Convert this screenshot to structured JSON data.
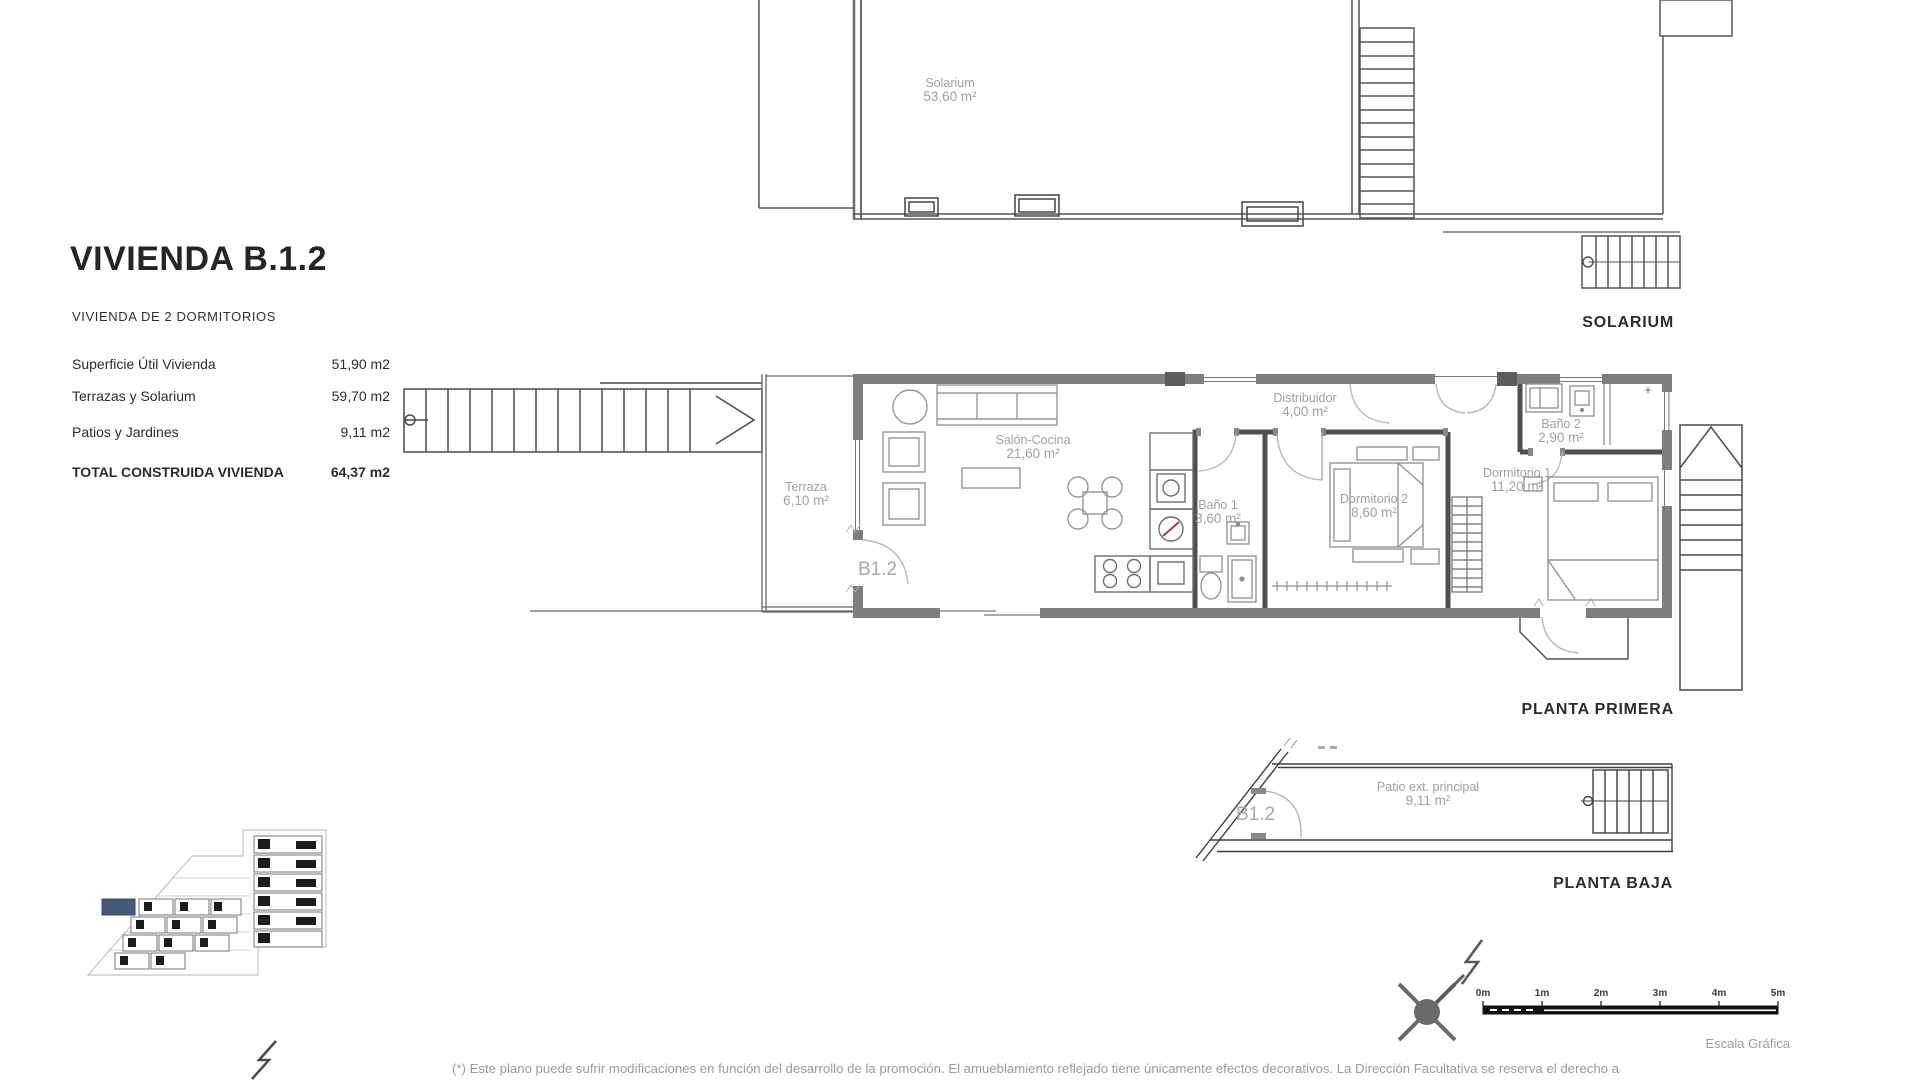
{
  "header": {
    "title": "VIVIENDA B.1.2",
    "subtitle": "VIVIENDA DE 2 DORMITORIOS"
  },
  "areas_table": {
    "rows": [
      {
        "label": "Superficie Útil Vivienda",
        "value": "51,90 m2"
      },
      {
        "label": "Terrazas y Solarium",
        "value": "59,70 m2"
      },
      {
        "label": "Patios y Jardines",
        "value": "9,11 m2"
      }
    ],
    "total_row": {
      "label": "TOTAL CONSTRUIDA VIVIENDA",
      "value": "64,37 m2"
    }
  },
  "plans": {
    "solarium": {
      "caption": "SOLARIUM",
      "room": {
        "name": "Solarium",
        "area": "53,60 m²"
      }
    },
    "first_floor": {
      "caption": "PLANTA PRIMERA",
      "unit_label": "B1.2",
      "rooms": {
        "terraza": {
          "name": "Terraza",
          "area": "6,10 m²"
        },
        "salon": {
          "name": "Salón-Cocina",
          "area": "21,60 m²"
        },
        "bano1": {
          "name": "Baño 1",
          "area": "3,60 m²"
        },
        "distribuidor": {
          "name": "Distribuidor",
          "area": "4,00 m²"
        },
        "dormitorio2": {
          "name": "Dormitorio 2",
          "area": "8,60 m²"
        },
        "bano2": {
          "name": "Baño 2",
          "area": "2,90 m²"
        },
        "dormitorio1": {
          "name": "Dormitorio 1",
          "area": "11,20 m²"
        }
      }
    },
    "ground_floor": {
      "caption": "PLANTA BAJA",
      "unit_label": "B1.2",
      "rooms": {
        "patio": {
          "name": "Patio ext. principal",
          "area": "9,11 m²"
        }
      }
    }
  },
  "scale_bar": {
    "caption": "Escala Gráfica",
    "ticks": [
      "0m",
      "1m",
      "2m",
      "3m",
      "4m",
      "5m"
    ]
  },
  "site_map": {
    "highlight_color": "#46597a"
  },
  "footnote": "(*) Este plano puede sufrir modificaciones en función del desarrollo de la promoción. El amueblamiento reflejado tiene únicamente efectos decorativos. La Dirección Facultativa se reserva el derecho a"
}
